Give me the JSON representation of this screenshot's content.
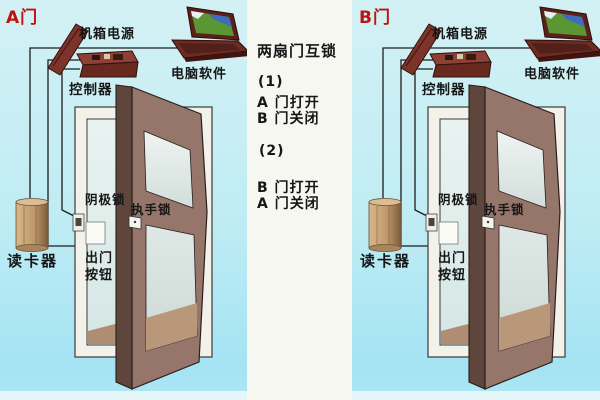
{
  "doors": [
    {
      "door_label": "A门",
      "power_label": "机箱电源",
      "software_label": "电脑软件",
      "controller_label": "控制器",
      "cathode_lock_label": "阴极锁",
      "handle_lock_label": "执手锁",
      "card_reader_label": "读卡器",
      "exit_button_label": "出门\n按钮"
    },
    {
      "door_label": "B门",
      "power_label": "机箱电源",
      "software_label": "电脑软件",
      "controller_label": "控制器",
      "cathode_lock_label": "阴极锁",
      "handle_lock_label": "执手锁",
      "card_reader_label": "读卡器",
      "exit_button_label": "出门\n按钮"
    }
  ],
  "center_panel": {
    "title": "两扇门互锁",
    "case1_num": "(1)",
    "case1_line1": "A  门打开",
    "case1_line2": "B  门关闭",
    "case2_num": "(2)",
    "case2_line1": "B  门打开",
    "case2_line2": "A  门关闭"
  },
  "colors": {
    "background_top": "#d3f1f4",
    "background_bottom": "#a4e3f3",
    "panel": "#f7f7f2",
    "door_leaf": "#96756a",
    "door_frame": "#f2f1ea",
    "device_box": "#7c342a",
    "card_reader": "#c09a6c",
    "label_red": "#c01310",
    "label_black": "#161616",
    "wire": "#1c1c1c"
  }
}
